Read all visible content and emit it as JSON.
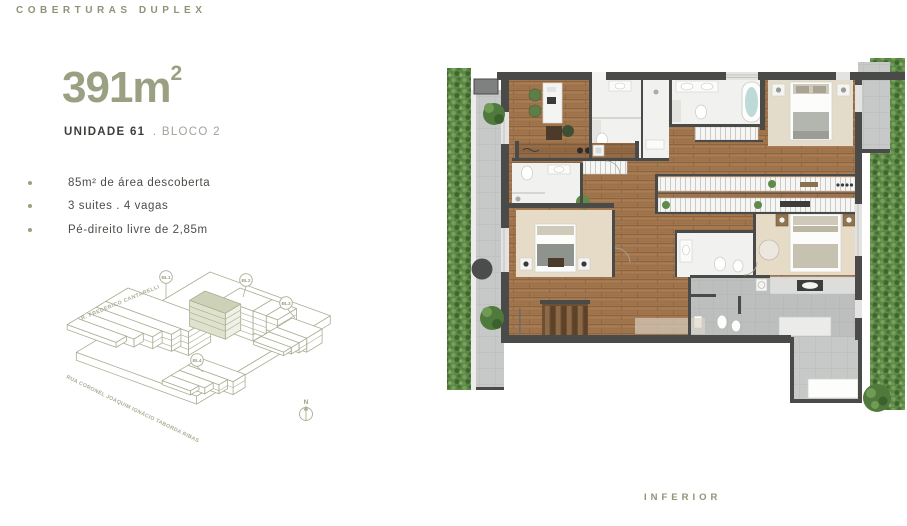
{
  "header": {
    "title": "COBERTURAS DUPLEX"
  },
  "unit": {
    "area": "391m",
    "area_exponent": "2",
    "name": "UNIDADE 61",
    "block": ". BLOCO 2"
  },
  "features": {
    "items": [
      "85m² de área descoberta",
      "3 suites . 4 vagas",
      "Pé-direito livre de 2,85m"
    ]
  },
  "site_map": {
    "blocks": [
      "BL1",
      "BL2",
      "BL3",
      "BL4"
    ],
    "street_top": "R. FREDERICO CANTARELLI",
    "street_bottom": "RUA CORONEL JOAQUIM IGNÁCIO TABORDA RIBAS",
    "compass_label": "N"
  },
  "floor_plan": {
    "caption": "INFERIOR"
  },
  "colors": {
    "accent_olive": "#9aa183",
    "diagram_line": "#a9ae93",
    "diagram_highlight": "#ccd1b7",
    "text_dark": "#4b4b46",
    "wall_dark": "#4a4a48"
  }
}
